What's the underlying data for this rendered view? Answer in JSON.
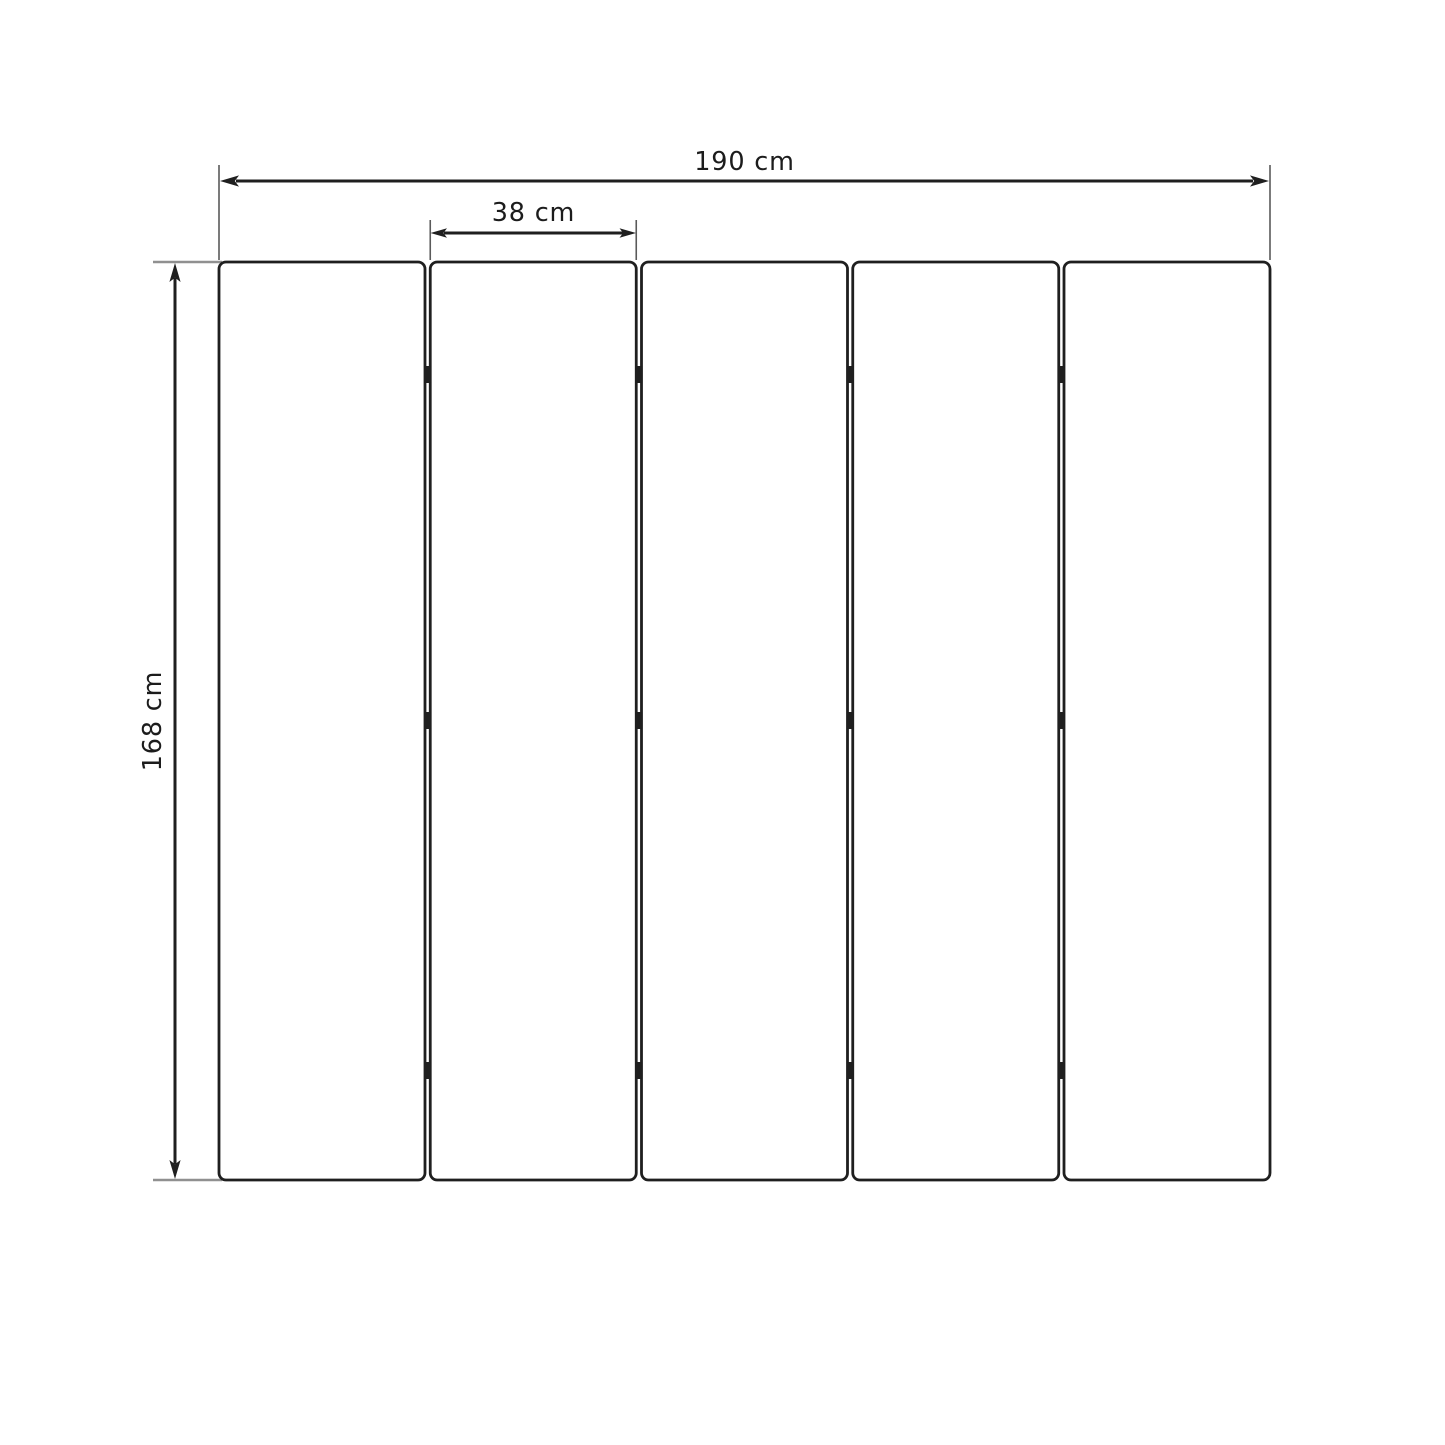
{
  "diagram": {
    "type": "dimension-drawing",
    "subject": "five-panel folding screen front view",
    "panel_count": 5,
    "hinge_rows": 3,
    "hinges_per_row": 4,
    "dimensions": {
      "total_width": {
        "label": "190 cm",
        "value_cm": 190,
        "orientation": "horizontal"
      },
      "panel_width": {
        "label": "38 cm",
        "value_cm": 38,
        "orientation": "horizontal"
      },
      "height": {
        "label": "168 cm",
        "value_cm": 168,
        "orientation": "vertical"
      }
    },
    "colors": {
      "background": "#ffffff",
      "line": "#1f1f1f",
      "extension_line": "#5a5a5a",
      "extension_line_light": "#909090",
      "text": "#1c1c1c"
    }
  }
}
